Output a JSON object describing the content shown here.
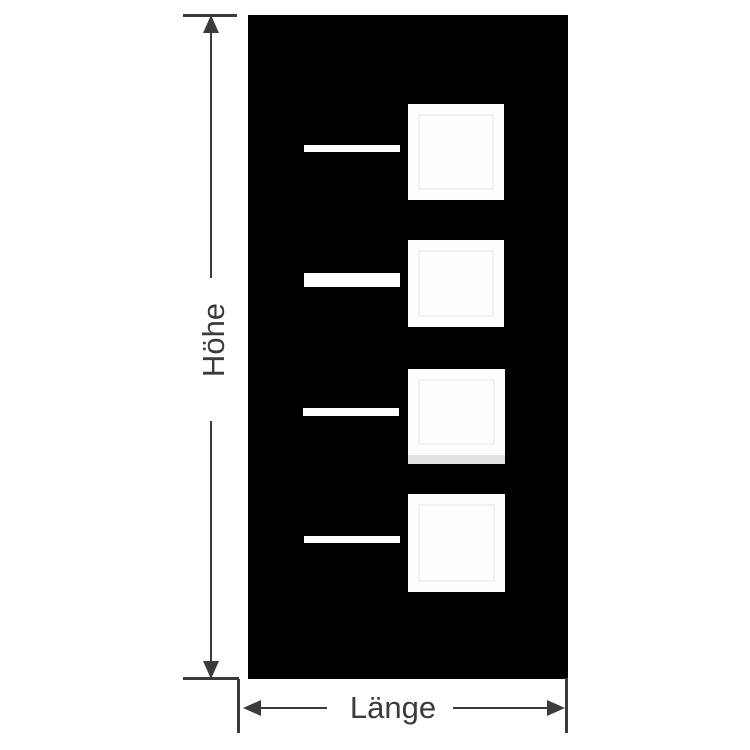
{
  "diagram": {
    "type": "dimension-drawing",
    "labels": {
      "height": "Höhe",
      "length": "Länge"
    },
    "colors": {
      "background": "#ffffff",
      "panel": "#000000",
      "cutout": "#fdfdfd",
      "window_inner_border": "#f0f1f3",
      "window_shadow_band": "#e2e2e4",
      "dimension_line": "#3b3b3d",
      "label_text": "#3b3b3d"
    },
    "panel": {
      "x": 248,
      "y": 15,
      "width": 320,
      "height": 664
    },
    "slots": [
      {
        "x": 304,
        "y": 145,
        "width": 96,
        "height": 7
      },
      {
        "x": 304,
        "y": 273,
        "width": 96,
        "height": 14
      },
      {
        "x": 303,
        "y": 408,
        "width": 96,
        "height": 8
      },
      {
        "x": 304,
        "y": 536,
        "width": 96,
        "height": 7
      }
    ],
    "windows": [
      {
        "x": 408,
        "y": 104,
        "width": 96,
        "height": 96,
        "shadow_band": false,
        "shadow_height": 0
      },
      {
        "x": 408,
        "y": 240,
        "width": 96,
        "height": 87,
        "shadow_band": false,
        "shadow_height": 0
      },
      {
        "x": 408,
        "y": 369,
        "width": 97,
        "height": 86,
        "shadow_band": true,
        "shadow_height": 9
      },
      {
        "x": 408,
        "y": 494,
        "width": 97,
        "height": 98,
        "shadow_band": false,
        "shadow_height": 0
      }
    ]
  }
}
